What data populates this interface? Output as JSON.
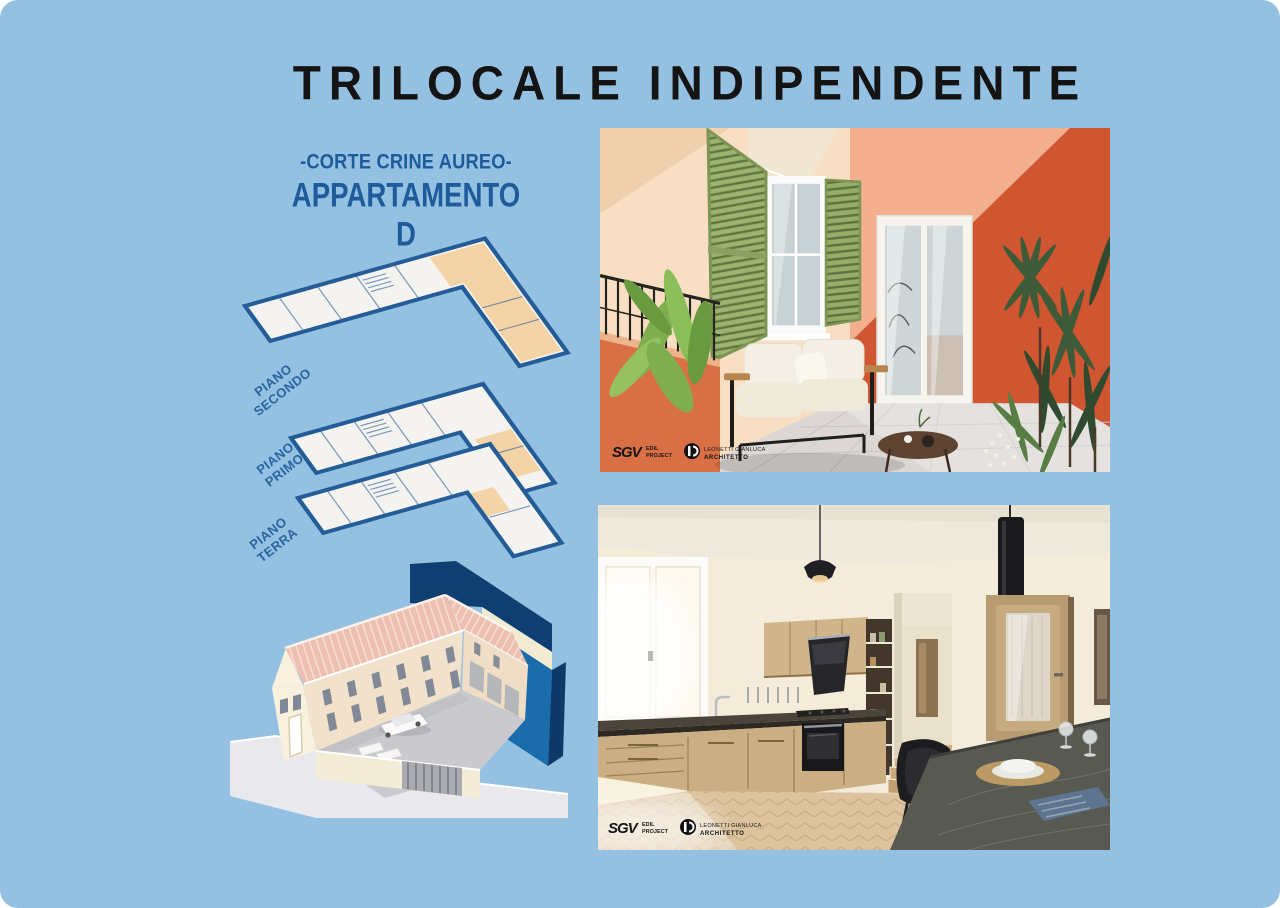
{
  "title": "TRILOCALE INDIPENDENTE",
  "heading": {
    "line1": "-CORTE CRINE AUREO-",
    "line2": "APPARTAMENTO D"
  },
  "floor_labels": [
    {
      "top": "PIANO",
      "bottom": "SECONDO"
    },
    {
      "top": "PIANO",
      "bottom": "PRIMO"
    },
    {
      "top": "PIANO",
      "bottom": "TERRA"
    }
  ],
  "watermark": {
    "sgv": "SGV",
    "line1": "EDIL",
    "line2": "PROJECT",
    "architect": "LEONETTI GIANLUCA",
    "role": "ARCHITETTO"
  },
  "colors": {
    "background": "#94c1e2",
    "title_black": "#141414",
    "heading_blue": "#1d5b9b",
    "plan_wall_blue": "#235c96",
    "plan_highlight_peach": "#f4d4a6",
    "roof_pink": "#ecbfb1",
    "building_cream": "#f3e2cb",
    "highlight_navy": "#0f3f72",
    "highlight_blue": "#1b6cab",
    "terrace_wall_orange": "#d05531",
    "shutter_green": "#9cb36f",
    "kitchen_wood": "#cbae83"
  }
}
